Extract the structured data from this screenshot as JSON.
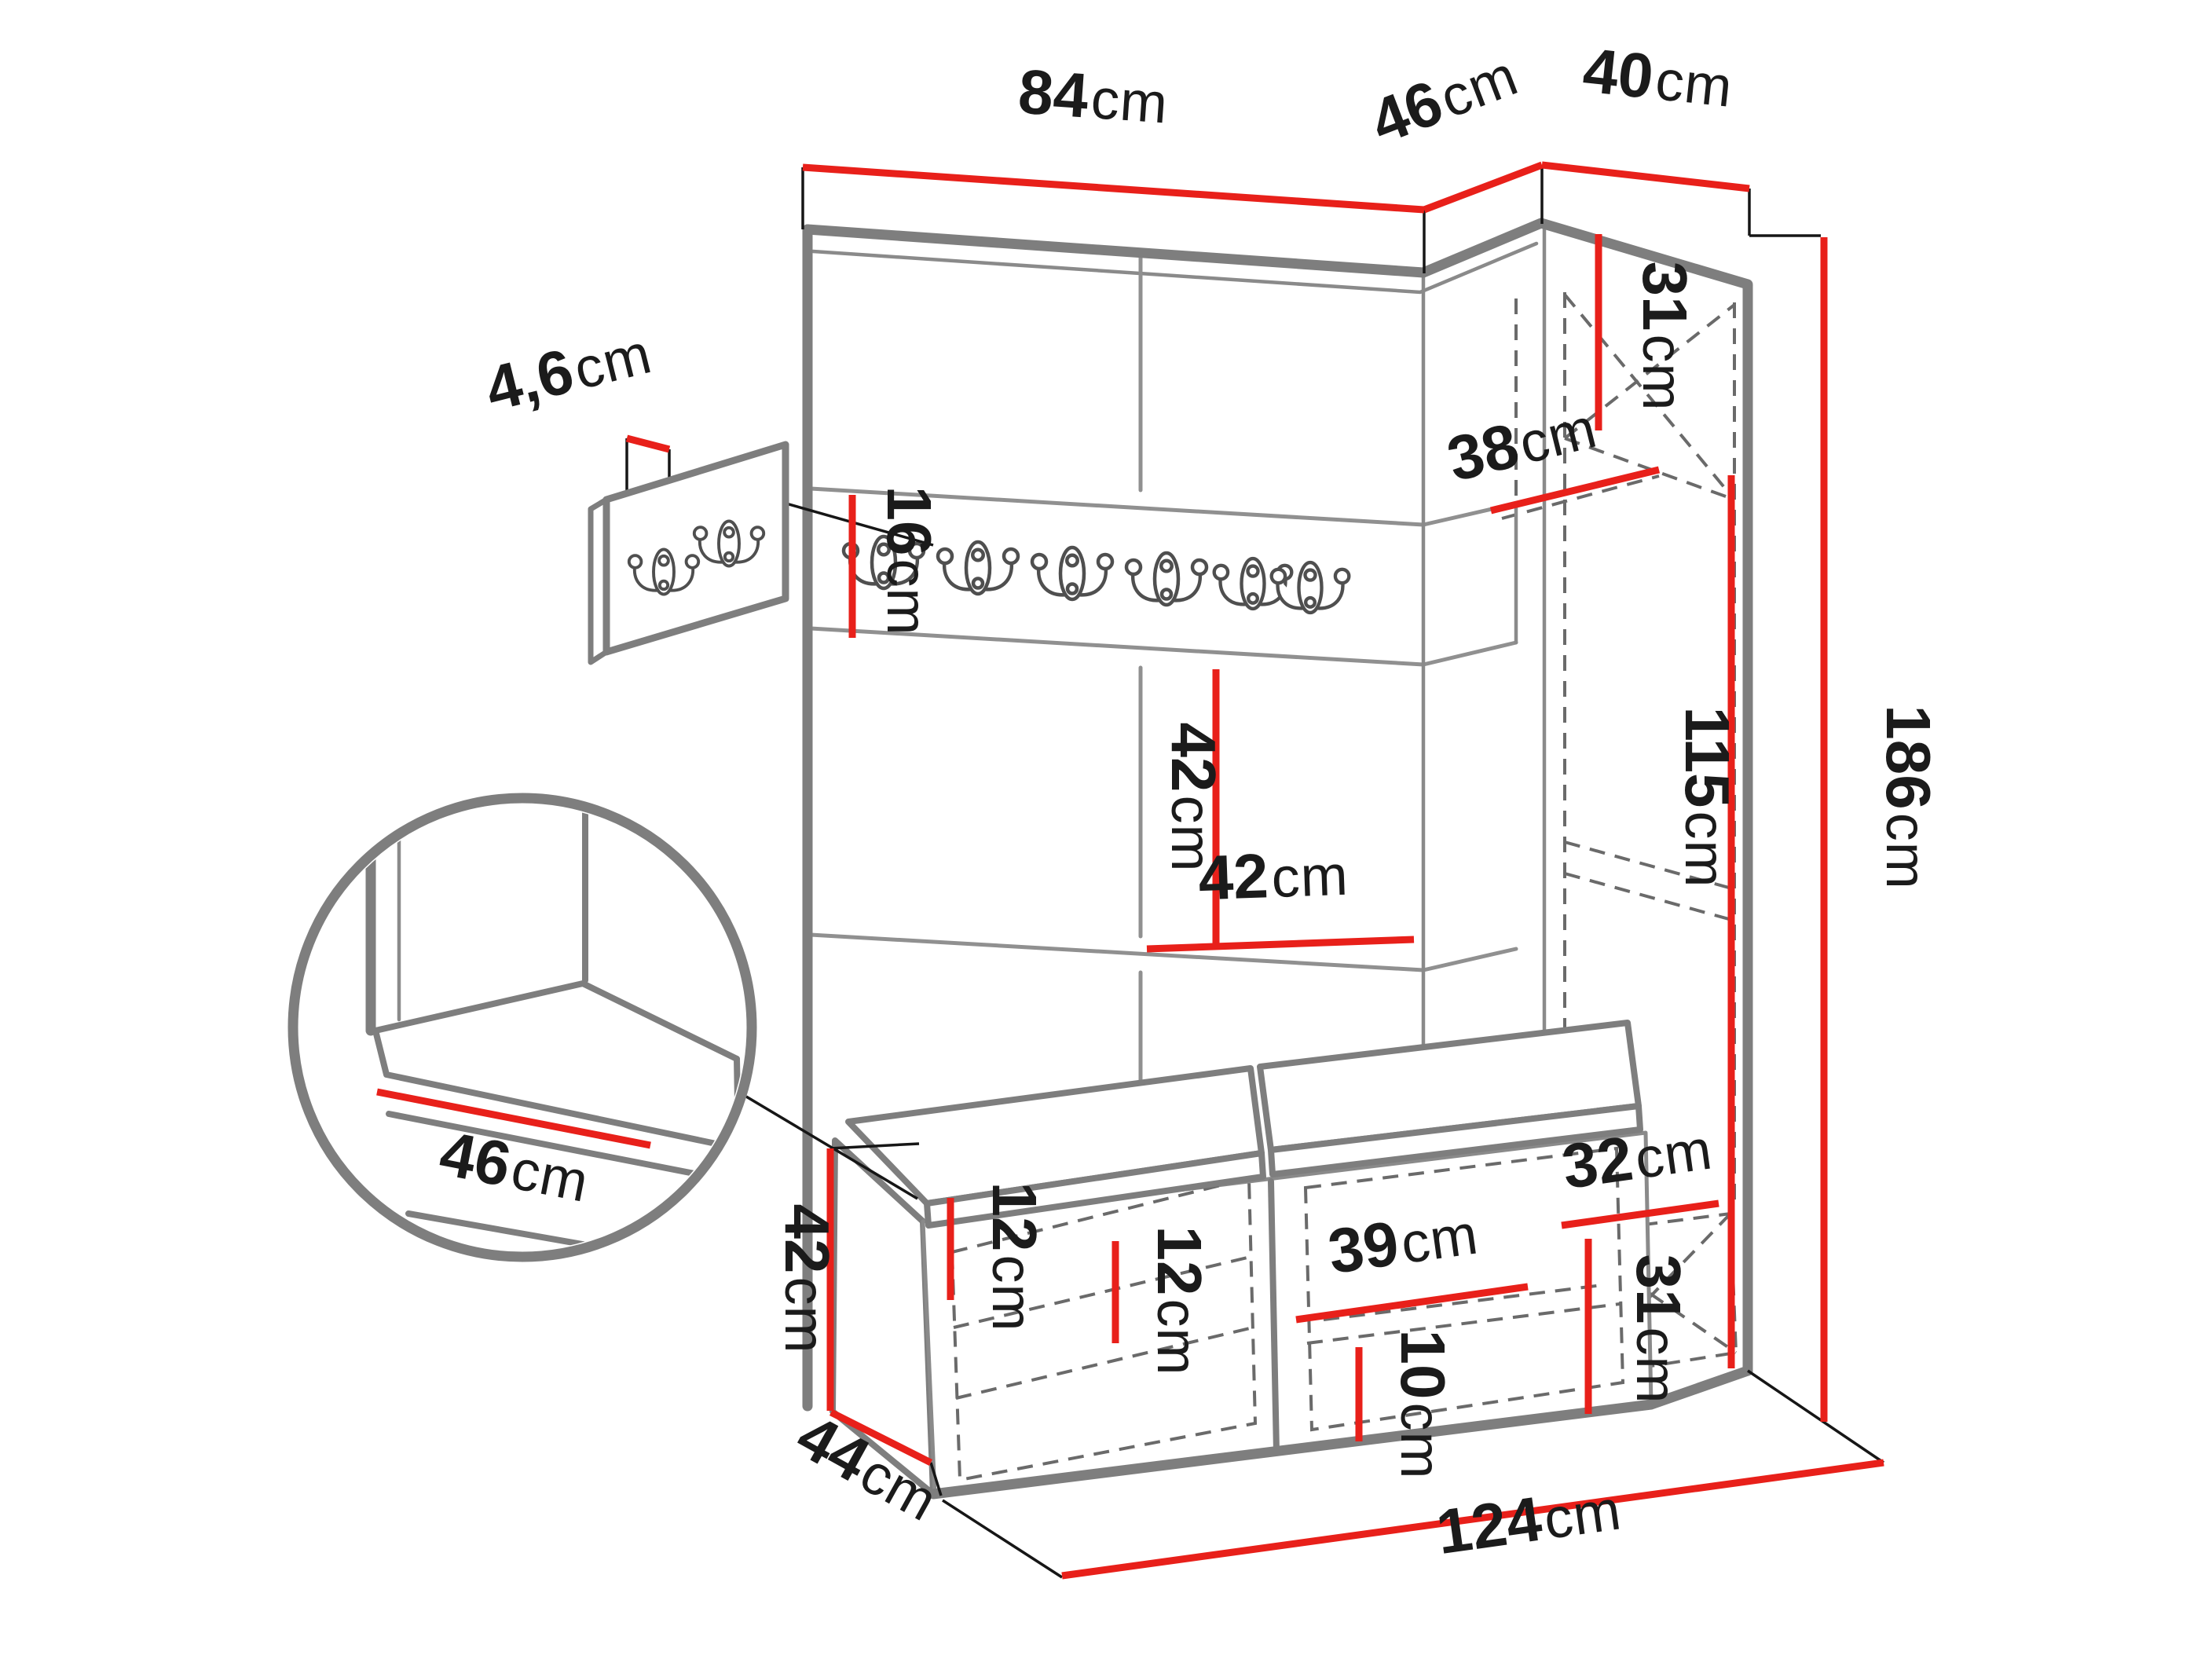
{
  "page": {
    "background": "#ffffff"
  },
  "diagram": {
    "type": "furniture-dimension-diagram",
    "subject": "hallway wardrobe set with coat hook rail, corner cabinet, bench and shoe storage",
    "unit": "cm",
    "colors": {
      "dimension_line": "#e8201a",
      "outline": "#7e7e7e",
      "hidden_edge": "#6a6a6a",
      "label_text": "#1b1b1b"
    },
    "labels": {
      "top_width_left": {
        "num": "84",
        "unit": "cm"
      },
      "top_width_corner": {
        "num": "46",
        "unit": "cm"
      },
      "top_width_right": {
        "num": "40",
        "unit": "cm"
      },
      "panel_thickness": {
        "num": "4,6",
        "unit": "cm"
      },
      "rail_height": {
        "num": "16",
        "unit": "cm"
      },
      "tile_height": {
        "num": "42",
        "unit": "cm"
      },
      "tile_width": {
        "num": "42",
        "unit": "cm"
      },
      "cabinet_top_height": {
        "num": "31",
        "unit": "cm"
      },
      "cabinet_depth": {
        "num": "38",
        "unit": "cm"
      },
      "cabinet_side_height": {
        "num": "115",
        "unit": "cm"
      },
      "total_height": {
        "num": "186",
        "unit": "cm"
      },
      "total_width": {
        "num": "124",
        "unit": "cm"
      },
      "bench_height": {
        "num": "42",
        "unit": "cm"
      },
      "bench_depth": {
        "num": "44",
        "unit": "cm"
      },
      "left_shelf_gap_upper": {
        "num": "12",
        "unit": "cm"
      },
      "left_shelf_gap_lower": {
        "num": "12",
        "unit": "cm"
      },
      "middle_box_width": {
        "num": "39",
        "unit": "cm"
      },
      "middle_shelf_gap": {
        "num": "10",
        "unit": "cm"
      },
      "base_box_width": {
        "num": "32",
        "unit": "cm"
      },
      "base_box_height": {
        "num": "31",
        "unit": "cm"
      },
      "seat_depth": {
        "num": "46",
        "unit": "cm"
      }
    }
  }
}
